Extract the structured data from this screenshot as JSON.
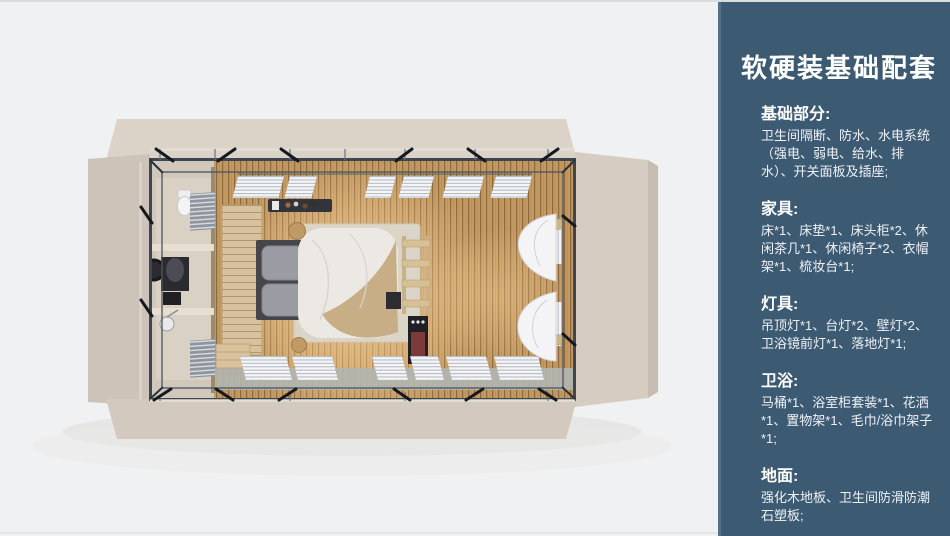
{
  "page": {
    "background": "#f0f1f2",
    "top_edge": "#dbdcdc"
  },
  "floorplan": {
    "colors": {
      "shell_top": "#dbd2c8",
      "shell_left": "#cdc3b8",
      "shell_right": "#d6ccc1",
      "shell_bottom": "#d3c9bf",
      "frame": "#3e4751",
      "wood_floor": "#c49a63",
      "wood_line": "#8d683c",
      "glow": "#ffd9a0",
      "bath_floor": "#d9d1c4",
      "partition_wall": "#e6dfd1",
      "wardrobe": "#d8c19e",
      "rug": "#dbd5c8",
      "duvet": "#ece9e4",
      "throw_blanket": "#c6ab82",
      "headboard": "#46464a",
      "pillow": "#9b9ba3",
      "louver": "#f4f5f7",
      "walkway": "#b2b5b0",
      "brace": "#15191e",
      "curtain": "#f4f3f5",
      "shelf_wood": "#d6c096",
      "minibar": "#1f1f25",
      "minibar_accent": "#7d3a3a"
    }
  },
  "sidebar": {
    "background": "#3d5a73",
    "edge": "#54718a",
    "text_color": "#ffffff",
    "title": "软硬装基础配套",
    "sections": [
      {
        "heading": "基础部分:",
        "body": "卫生间隔断、防水、水电系统（强电、弱电、给水、排水）、开关面板及插座;"
      },
      {
        "heading": "家具:",
        "body": "床*1、床垫*1、床头柜*2、休闲茶几*1、休闲椅子*2、衣帽架*1、梳妆台*1;"
      },
      {
        "heading": "灯具:",
        "body": "吊顶灯*1、台灯*2、壁灯*2、卫浴镜前灯*1、落地灯*1;"
      },
      {
        "heading": "卫浴:",
        "body": "马桶*1、浴室柜套装*1、花洒*1、置物架*1、毛巾/浴巾架子*1;"
      },
      {
        "heading": "地面:",
        "body": "强化木地板、卫生间防滑防潮石塑板;"
      }
    ]
  }
}
